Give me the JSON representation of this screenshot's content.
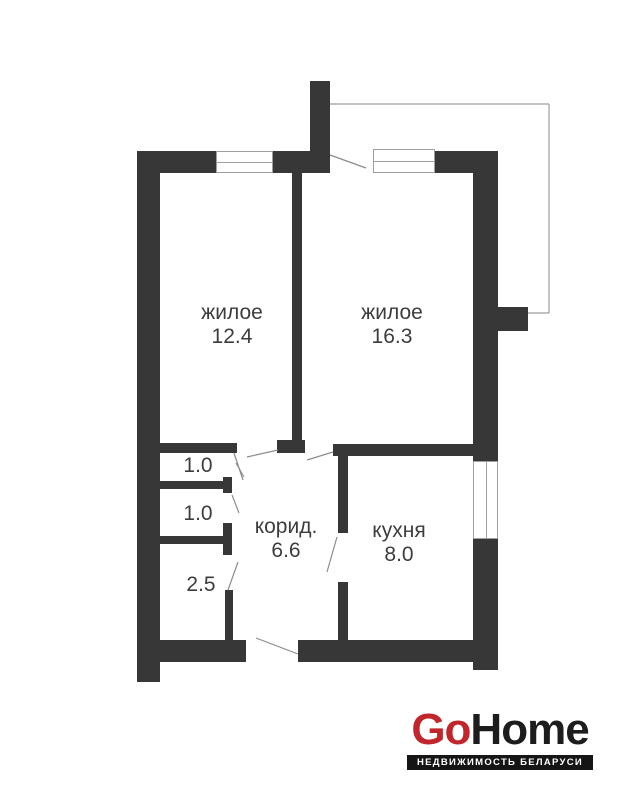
{
  "rooms": {
    "living1": {
      "name": "жилое",
      "area": "12.4"
    },
    "living2": {
      "name": "жилое",
      "area": "16.3"
    },
    "corridor": {
      "name": "корид.",
      "area": "6.6"
    },
    "kitchen": {
      "name": "кухня",
      "area": "8.0"
    },
    "store1": {
      "area": "1.0"
    },
    "store2": {
      "area": "1.0"
    },
    "store3": {
      "area": "2.5"
    }
  },
  "logo": {
    "brand_red": "Go",
    "brand_dark": "Home",
    "tagline": "НЕДВИЖИМОСТЬ БЕЛАРУСИ",
    "red_color": "#c0262c",
    "dark_color": "#1d1d1d"
  },
  "floorplan": {
    "colors": {
      "wall": "#373737",
      "thin_line": "#8c8c8c",
      "outline": "#9e9e9e",
      "label_text": "#3d3d3d"
    },
    "walls": [
      {
        "name": "top-wall-left",
        "x": 137,
        "y": 151,
        "w": 79,
        "h": 22
      },
      {
        "name": "top-wall-mid",
        "x": 273,
        "y": 151,
        "w": 57,
        "h": 22
      },
      {
        "name": "top-wall-right",
        "x": 434,
        "y": 151,
        "w": 64,
        "h": 22
      },
      {
        "name": "chimney-stub",
        "x": 310,
        "y": 81,
        "w": 20,
        "h": 92
      },
      {
        "name": "left-wall",
        "x": 137,
        "y": 151,
        "w": 23,
        "h": 531
      },
      {
        "name": "right-wall-upper",
        "x": 473,
        "y": 151,
        "w": 25,
        "h": 310
      },
      {
        "name": "right-wall-lower",
        "x": 473,
        "y": 539,
        "w": 25,
        "h": 131
      },
      {
        "name": "right-protrusion",
        "x": 498,
        "y": 307,
        "w": 30,
        "h": 24
      },
      {
        "name": "living-partition",
        "x": 292,
        "y": 173,
        "w": 10,
        "h": 267
      },
      {
        "name": "living-partition-foot",
        "x": 277,
        "y": 440,
        "w": 28,
        "h": 13
      },
      {
        "name": "corridor-top-wall",
        "x": 160,
        "y": 443,
        "w": 77,
        "h": 10
      },
      {
        "name": "kitchen-top-wall",
        "x": 333,
        "y": 444,
        "w": 140,
        "h": 12
      },
      {
        "name": "kitchen-west-upper",
        "x": 338,
        "y": 444,
        "w": 10,
        "h": 89
      },
      {
        "name": "kitchen-west-lower",
        "x": 338,
        "y": 582,
        "w": 10,
        "h": 58
      },
      {
        "name": "store-wall-1",
        "x": 159,
        "y": 481,
        "w": 64,
        "h": 8
      },
      {
        "name": "store-wall-1-cap",
        "x": 223,
        "y": 477,
        "w": 9,
        "h": 16
      },
      {
        "name": "store-wall-2",
        "x": 159,
        "y": 536,
        "w": 64,
        "h": 8
      },
      {
        "name": "store-wall-2-cap",
        "x": 223,
        "y": 523,
        "w": 9,
        "h": 32
      },
      {
        "name": "store3-partition",
        "x": 225,
        "y": 590,
        "w": 8,
        "h": 50
      },
      {
        "name": "bottom-wall-left",
        "x": 159,
        "y": 640,
        "w": 87,
        "h": 22
      },
      {
        "name": "bottom-wall-right",
        "x": 298,
        "y": 640,
        "w": 175,
        "h": 22
      }
    ],
    "windows": [
      {
        "name": "window-living1",
        "orient": "h",
        "x": 216,
        "y": 151,
        "w": 57,
        "h": 22
      },
      {
        "name": "window-living2",
        "orient": "h",
        "x": 373,
        "y": 149,
        "w": 62,
        "h": 24
      },
      {
        "name": "window-kitchen",
        "orient": "v",
        "x": 473,
        "y": 461,
        "w": 25,
        "h": 78
      }
    ],
    "balcony_lines": [
      {
        "x1": 330,
        "y1": 104,
        "x2": 549,
        "y2": 104
      },
      {
        "x1": 549,
        "y1": 104,
        "x2": 549,
        "y2": 313
      },
      {
        "x1": 549,
        "y1": 313,
        "x2": 528,
        "y2": 313
      }
    ],
    "door_lines": [
      {
        "name": "balcony-door",
        "x1": 330,
        "y1": 155,
        "x2": 366,
        "y2": 168
      },
      {
        "name": "living1-door-a",
        "x1": 234,
        "y1": 453,
        "x2": 243,
        "y2": 480
      },
      {
        "name": "living1-door-b",
        "x1": 247,
        "y1": 457,
        "x2": 278,
        "y2": 450
      },
      {
        "name": "living2-door",
        "x1": 307,
        "y1": 460,
        "x2": 333,
        "y2": 452
      },
      {
        "name": "store1-door",
        "x1": 236,
        "y1": 463,
        "x2": 244,
        "y2": 477
      },
      {
        "name": "store2-door",
        "x1": 232,
        "y1": 495,
        "x2": 239,
        "y2": 513
      },
      {
        "name": "store3-door",
        "x1": 228,
        "y1": 590,
        "x2": 238,
        "y2": 562
      },
      {
        "name": "kitchen-door",
        "x1": 327,
        "y1": 572,
        "x2": 337,
        "y2": 537
      },
      {
        "name": "entrance-door",
        "x1": 256,
        "y1": 638,
        "x2": 298,
        "y2": 654
      }
    ]
  }
}
